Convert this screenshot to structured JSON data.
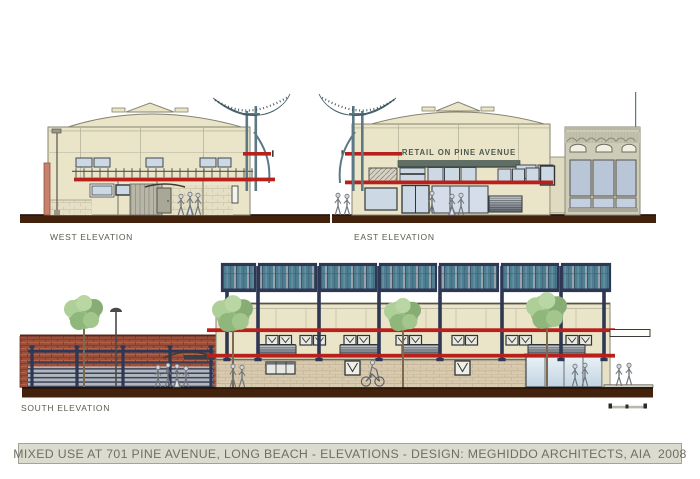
{
  "title_bar": {
    "text": "MIXED USE AT 701 PINE AVENUE, LONG BEACH - ELEVATIONS - DESIGN: MEGHIDDO ARCHITECTS, AIA  2008"
  },
  "elevations": {
    "west": {
      "label": "WEST ELEVATION"
    },
    "east": {
      "label": "EAST ELEVATION",
      "retail_sign": "RETAIL ON PINE AVENUE"
    },
    "south": {
      "label": "SOUTH ELEVATION"
    }
  },
  "colors": {
    "page_bg": "#ffffff",
    "accent_red": "#b8201b",
    "facade_cream": "#eae5c9",
    "window_blue": "#cdd8e5",
    "slate": "#5c7984",
    "navy": "#2e3753",
    "panel_teal": "#4e7e91",
    "ground_brown": "#42220c",
    "brick_red": "#9e4f3a",
    "stone_tan": "#d8cbb0",
    "adjacent_gray": "#cdccb8",
    "canopy_green": "#5f6e66",
    "sign_green": "#4c5a4e",
    "tree_green": "#97bc83",
    "pilaster_pink": "#c9806c",
    "title_text": "#70705f",
    "title_bar_bg": "#dbdbd0",
    "label_text": "#5c594c"
  }
}
